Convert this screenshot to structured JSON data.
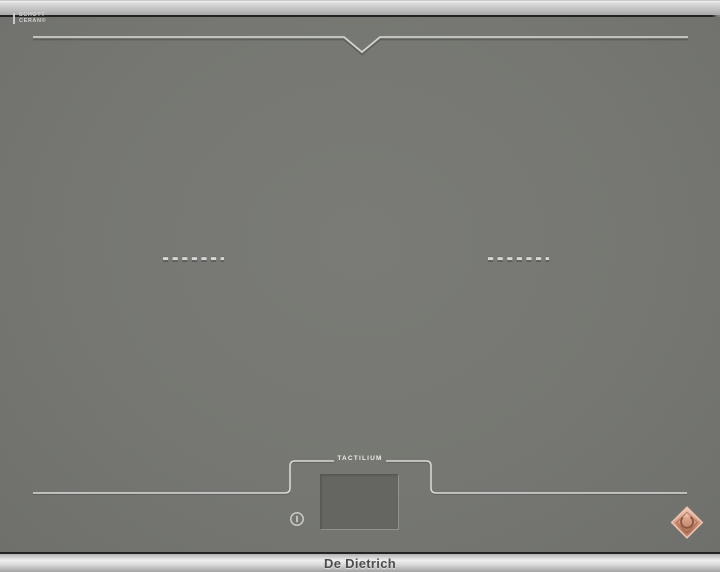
{
  "brand": {
    "name": "De Dietrich"
  },
  "surface": {
    "glass_logo_line1": "SCHOTT",
    "glass_logo_line2": "CERAN®",
    "control_panel_label": "TACTILIUM"
  },
  "icons": [
    {
      "name": "schott-ceran-logo",
      "meaning": "glass ceramic maker mark"
    },
    {
      "name": "power-icon",
      "meaning": "power touch key printed on glass"
    },
    {
      "name": "de-dietrich-diamond-logo",
      "meaning": "copper diamond brand emblem"
    },
    {
      "name": "cooking-zone-marker",
      "meaning": "dashed pan position mark"
    }
  ],
  "colors": {
    "glass_surface": "#767772",
    "frame_metal": "#d8d8d8",
    "trim_line": "#d9d9d7",
    "display_screen": "#656561",
    "badge_copper": "#c98a72",
    "brand_text": "#4d4d4b"
  }
}
